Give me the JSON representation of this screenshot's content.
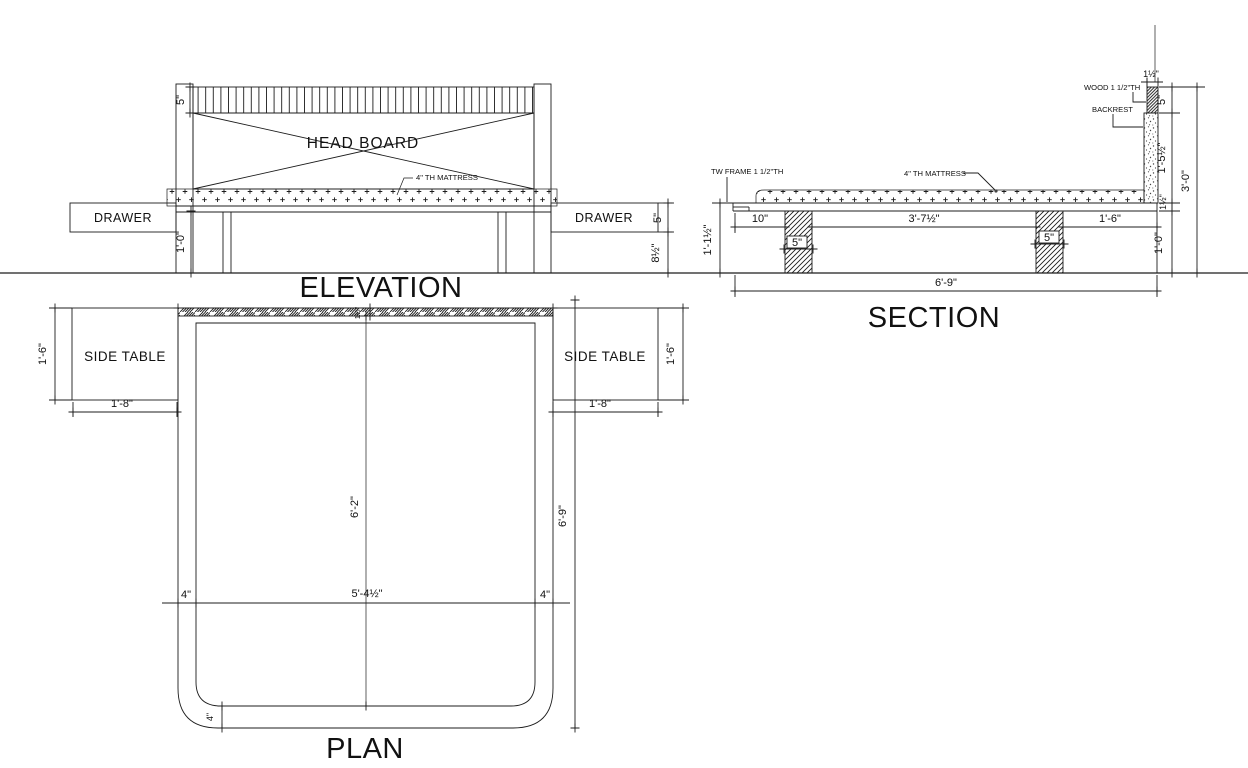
{
  "elevation": {
    "title": "ELEVATION",
    "head_board": "HEAD BOARD",
    "mattress_label": "4\" TH MATTRESS",
    "drawer_left": "DRAWER",
    "drawer_right": "DRAWER",
    "dim_slat_height": "5\"",
    "dim_leg_height": "1'-0\"",
    "dim_drawer_height": "5\"",
    "dim_under_drawer": "8½\""
  },
  "section": {
    "title": "SECTION",
    "label_frame": "TW FRAME 1 1/2\"TH",
    "label_mattress": "4\" TH MATTRESS",
    "label_wood": "WOOD 1 1/2\"TH",
    "label_backrest": "BACKREST",
    "dim_left_height": "1'-1½\"",
    "dim_offset_left": "10\"",
    "dim_leg1_width": "5\"",
    "dim_mid_span": "3'-7½\"",
    "dim_leg2_width": "5\"",
    "dim_right_span": "1'-6\"",
    "dim_total_width": "6'-9\"",
    "dim_backrest_th": "1½\"",
    "dim_wood_height": "5\"",
    "dim_backrest_height": "1'-5½\"",
    "dim_frame_th": "1½\"",
    "dim_leg_height": "1'-0\"",
    "dim_total_height": "3'-0\""
  },
  "plan": {
    "title": "PLAN",
    "side_table_left": "SIDE TABLE",
    "side_table_right": "SIDE TABLE",
    "dim_table_depth_left": "1'-6\"",
    "dim_table_width_left": "1'-8\"",
    "dim_table_depth_right": "1'-6\"",
    "dim_table_width_right": "1'-8\"",
    "dim_headboard_th": "1½\"",
    "dim_inner_length": "6'-2\"",
    "dim_total_length": "6'-9\"",
    "dim_frame_left": "4\"",
    "dim_inner_width": "5'-4½\"",
    "dim_frame_right": "4\"",
    "dim_frame_bottom": "4\""
  },
  "colors": {
    "line": "#1c1c1c",
    "marker_grey": "#98a0a6",
    "marker_green": "#63b44d",
    "background": "#ffffff"
  }
}
